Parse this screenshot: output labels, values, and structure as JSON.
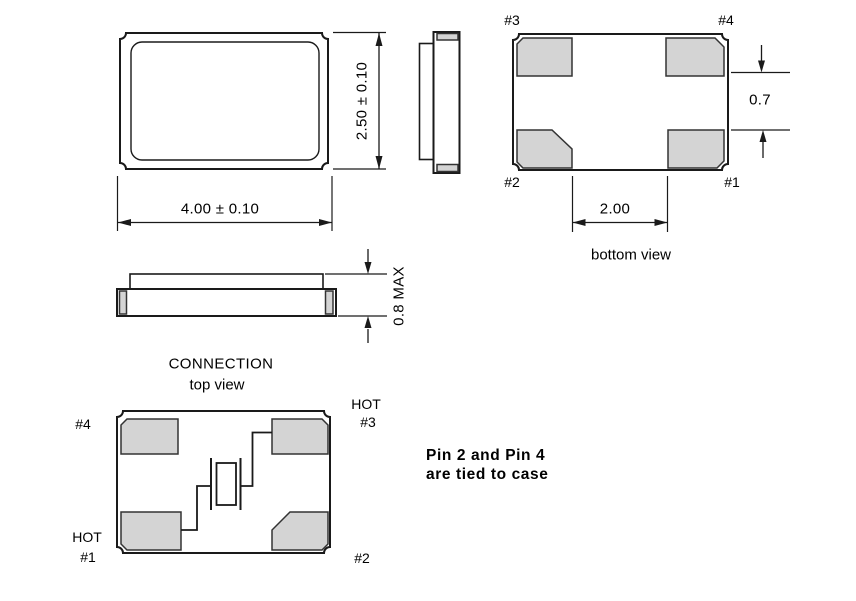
{
  "colors": {
    "line": "#1a1a1a",
    "pad_fill": "#d4d4d4",
    "pad_stroke": "#333333",
    "text": "#000000",
    "background": "#ffffff"
  },
  "top_view": {
    "width_dim": "4.00 ± 0.10",
    "height_dim": "2.50 ± 0.10"
  },
  "side_view": {
    "height_dim": "0.8 MAX"
  },
  "bottom_view": {
    "caption": "bottom view",
    "pin_top_left": "#3",
    "pin_top_right": "#4",
    "pin_bottom_left": "#2",
    "pin_bottom_right": "#1",
    "pad_dim": "0.7",
    "pitch_dim": "2.00"
  },
  "connection_view": {
    "title": "CONNECTION",
    "subtitle": "top view",
    "pin_top_left": "#4",
    "hot_top": "HOT",
    "pin_top_right": "#3",
    "hot_bottom": "HOT",
    "pin_bottom_left": "#1",
    "pin_bottom_right": "#2"
  },
  "note": {
    "line1": "Pin 2 and Pin 4",
    "line2": "are tied to case"
  }
}
